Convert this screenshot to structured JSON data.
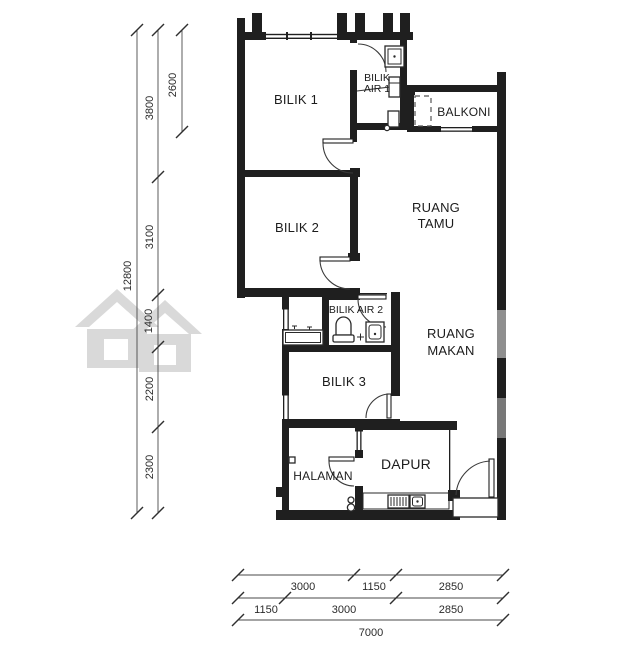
{
  "drawing_title": "floor-plan",
  "colors": {
    "wall": "#1f1f1f",
    "dimension": "#4a4a4a",
    "text": "#1c1c1c",
    "watermark": "#d9d9d9",
    "background": "#ffffff"
  },
  "rooms": {
    "bilik1": "BILIK 1",
    "bilik2": "BILIK 2",
    "bilik3": "BILIK 3",
    "bilik_air_1": [
      "BILIK",
      "AIR 1"
    ],
    "bilik_air_2": "BILIK AIR 2",
    "balkoni": "BALKONI",
    "ruang_tamu": [
      "RUANG",
      "TAMU"
    ],
    "ruang_makan": [
      "RUANG",
      "MAKAN"
    ],
    "halaman": "HALAMAN",
    "dapur": "DAPUR"
  },
  "dimensions": {
    "left": {
      "overall": "12800",
      "segments": [
        "3800",
        "3100",
        "1400",
        "2200",
        "2300"
      ],
      "inner_top": "2600"
    },
    "bottom": {
      "row1": [
        "3000",
        "1150",
        "2850"
      ],
      "row2": [
        "1150",
        "3000",
        "2850"
      ],
      "overall": "7000"
    }
  }
}
